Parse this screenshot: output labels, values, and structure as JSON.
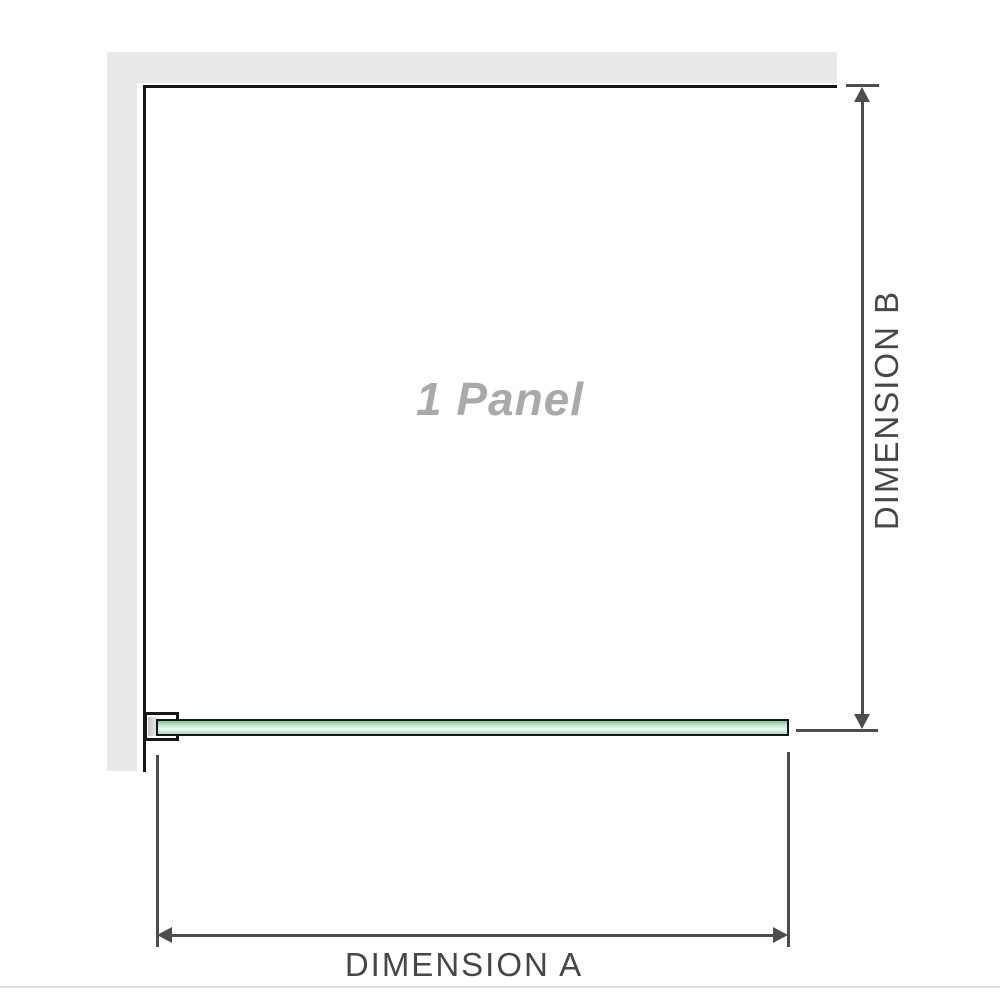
{
  "diagram": {
    "panel_label": "1 Panel",
    "dimension_a_label": "DIMENSION A",
    "dimension_b_label": "DIMENSION B"
  },
  "icons": {
    "arrow_up": "dimension-b-top-arrowhead",
    "arrow_down": "dimension-b-bottom-arrowhead",
    "arrow_left": "dimension-a-left-arrowhead",
    "arrow_right": "dimension-a-right-arrowhead"
  },
  "colors": {
    "wall": "#e9e9e9",
    "outline": "#161616",
    "dimension": "#4d4d4d",
    "label": "#474747",
    "panel_text": "#a9a9a9",
    "glass_top": "#7cc39b",
    "glass_mid1": "#c3e9d3",
    "glass_mid2": "#f0faf4",
    "glass_bottom": "#a6dabd",
    "baseline": "#e2dfd8"
  }
}
